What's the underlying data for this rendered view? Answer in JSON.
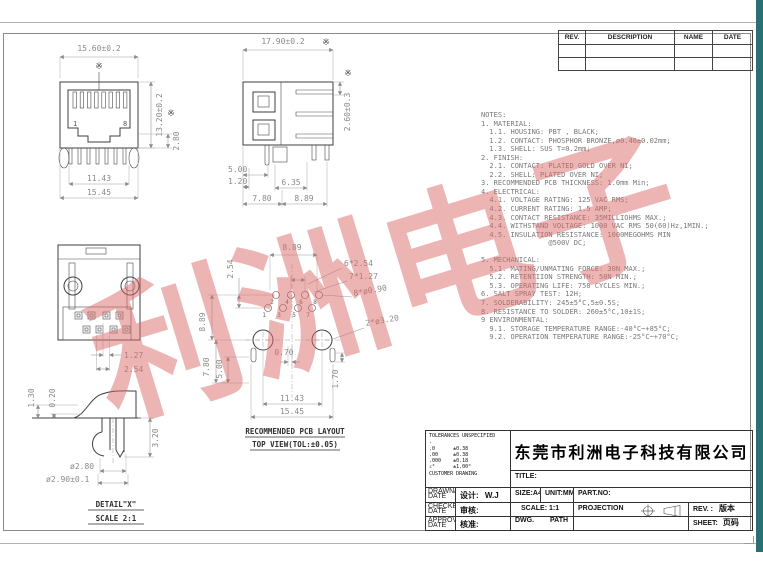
{
  "watermark": {
    "text": "利洲电子",
    "color": "#db6a6a"
  },
  "revision_table": {
    "headers": [
      "REV.",
      "DESCRIPTION",
      "NAME",
      "DATE"
    ],
    "empty_rows": 2
  },
  "notes": {
    "lines": [
      "NOTES:",
      "1. MATERIAL:",
      "  1.1. HOUSING: PBT , BLACK;",
      "  1.2. CONTACT: PHOSPHOR BRONZE,ø0.46±0.02mm;",
      "  1.3. SHELL: SUS T=0.2mm;",
      "2. FINISH:",
      "  2.1. CONTACT: PLATED GOLD OVER NI;",
      "  2.2. SHELL: PLATED OVER NI;",
      "3. RECOMMENDED PCB THICKNESS: 1.0mm Min;",
      "4. ELECTRICAL:",
      "  4.1. VOLTAGE RATING: 125 VAC RMS;",
      "  4.2. CURRENT RATING: 1.5 AMP;",
      "  4.3. CONTACT RESISTANCE: 35MILLIOHMS MAX.;",
      "  4.4. WITHSTAND VOLTAGE: 1000 VAC RMS 50(60)Hz,1MIN.;",
      "  4.5. INSULATION RESISTANCE: 1000MEGOHMS MIN",
      "                @500V DC;",
      "",
      "5. MECHANICAL:",
      "  5.1. MATING/UNMATING FORCE: 30N MAX.;",
      "  5.2. RETENTIION STRENGTH: 50N MIN.;",
      "  5.3. OPERATING LIFE: 750 CYCLES MIN.;",
      "6. SALT SPRAY TEST: 12H;",
      "7. SOLDERABILITY: 245±5°C,5±0.5S;",
      "8. RESISTANCE TO SOLDER: 260±5°C,10±1S;",
      "9 ENVIRONMENTAL:",
      "  9.1. STORAGE TEMPERATURE RANGE:-40°C~+85°C;",
      "  9.2. OPERATION TEMPERATURE RANGE:-25°C~+70°C;"
    ]
  },
  "front_view": {
    "dim_width": "15.60±0.2",
    "dim_height": "13.20±0.2",
    "dim_panel": "2.80",
    "dim_pins": "11.43",
    "dim_total": "15.45",
    "pin_first": "1",
    "pin_last": "8",
    "star": "※"
  },
  "side_view": {
    "dim_width": "17.90±0.2",
    "dim_tail": "2.60±0.3",
    "dim_a": "5.00",
    "dim_b": "1.20",
    "dim_c": "6.35",
    "dim_d": "7.80",
    "dim_e": "8.89",
    "star": "※"
  },
  "rear_view": {
    "dim_a": "1.27",
    "dim_b": "2.54"
  },
  "detail_view": {
    "dim_a": "1.30",
    "dim_b": "0.20",
    "dim_c": "3.20",
    "dim_d": "ø2.80",
    "dim_e": "ø2.90±0.1",
    "label": "DETAIL\"X\"",
    "scale_label": "SCALE 2:1"
  },
  "pcb_view": {
    "dim_top": "8.89",
    "dim_row": "2.54",
    "dim_p1": "6*2.54",
    "dim_p2": "7*1.27",
    "dim_p3": "8*ø0.90",
    "dim_p4": "2*ø3.20",
    "dim_left1": "8.89",
    "dim_left2": "7.80",
    "dim_left3": "5.00",
    "dim_mid": "0.70",
    "dim_r": "1.70",
    "dim_b1": "11.43",
    "dim_b2": "15.45",
    "pins": [
      "1",
      "2",
      "3",
      "4",
      "5",
      "6",
      "7",
      "8"
    ],
    "caption1": "RECOMMENDED PCB LAYOUT",
    "caption2": "TOP VIEW(TOL:±0.05)"
  },
  "title_block": {
    "company": "东莞市利洲电子科技有限公司",
    "title_label": "TITLE:",
    "tolerance_lines": [
      "TOLERANCES UNSPECIFIED",
      ".",
      ".0      ±0.38",
      ".00     ±0.38",
      ".000    ±0.18",
      "∠°      ±1.00°",
      "CUSTOMER DRAWING"
    ],
    "design_label": "设计:",
    "design_value": "W.J",
    "check_label": "审核:",
    "approve_label": "核准:",
    "drawn_tiny": "DRAWN/\nDATE",
    "checked_tiny": "CHECKED/\nDATE",
    "approved_tiny": "APPROVED/\nDATE",
    "size": "SIZE:A4",
    "unit": "UNIT:MM.",
    "part_no": "PART.NO:",
    "scale": "SCALE: 1:1",
    "projection": "PROJECTION",
    "rev_label": "REV. :",
    "rev_value": "版本",
    "dwg_label": "DWG.",
    "path_label": "PATH",
    "sheet_label": "SHEET:",
    "sheet_value": "页码"
  }
}
